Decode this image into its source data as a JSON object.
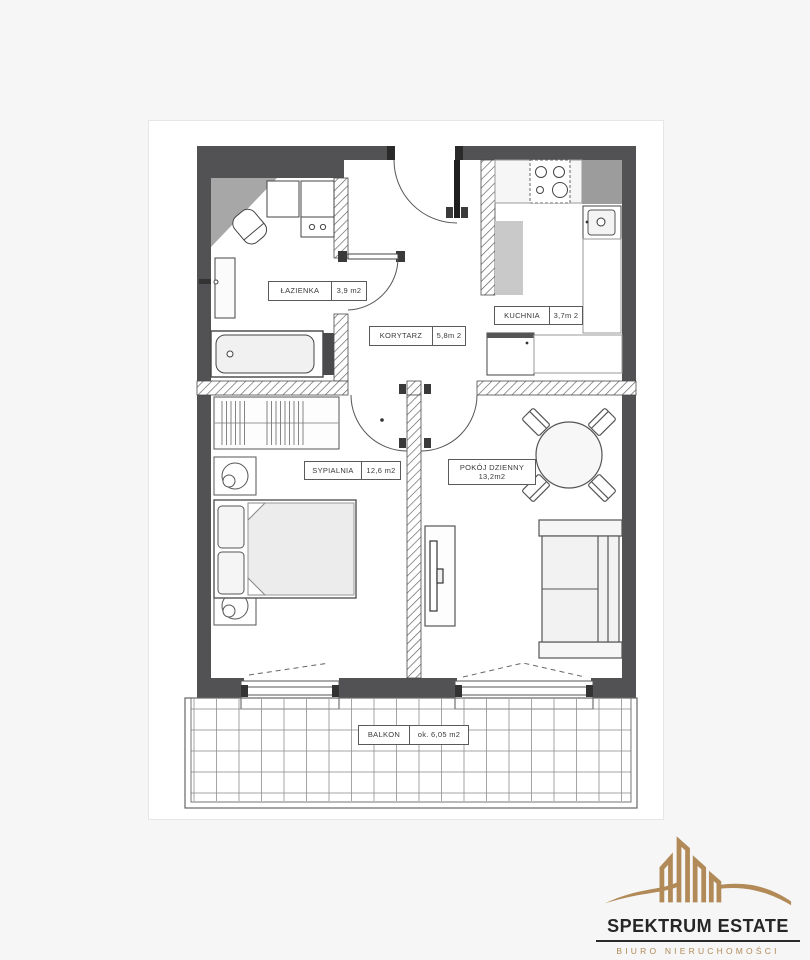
{
  "plan": {
    "rooms": [
      {
        "id": "lazienka",
        "name": "ŁAZIENKA",
        "area": "3,9 m2"
      },
      {
        "id": "korytarz",
        "name": "KORYTARZ",
        "area": "5,8m 2"
      },
      {
        "id": "kuchnia",
        "name": "KUCHNIA",
        "area": "3,7m 2"
      },
      {
        "id": "sypialnia",
        "name": "SYPIALNIA",
        "area": "12,6 m2"
      },
      {
        "id": "pokoj",
        "name": "POKÓJ DZIENNY",
        "area": "13,2m2"
      },
      {
        "id": "balkon",
        "name": "BALKON",
        "area": "ok. 6,05 m2"
      }
    ],
    "colors": {
      "wall": "#525254",
      "hatch": "#5a5a5a",
      "furniture_stroke": "#444444",
      "gray_fill": "#9c9c9c"
    }
  },
  "logo": {
    "title": "SPEKTRUM ESTATE",
    "subtitle": "BIURO NIERUCHOMOŚCI",
    "gold": "#b18a58",
    "text_color": "#262626"
  }
}
